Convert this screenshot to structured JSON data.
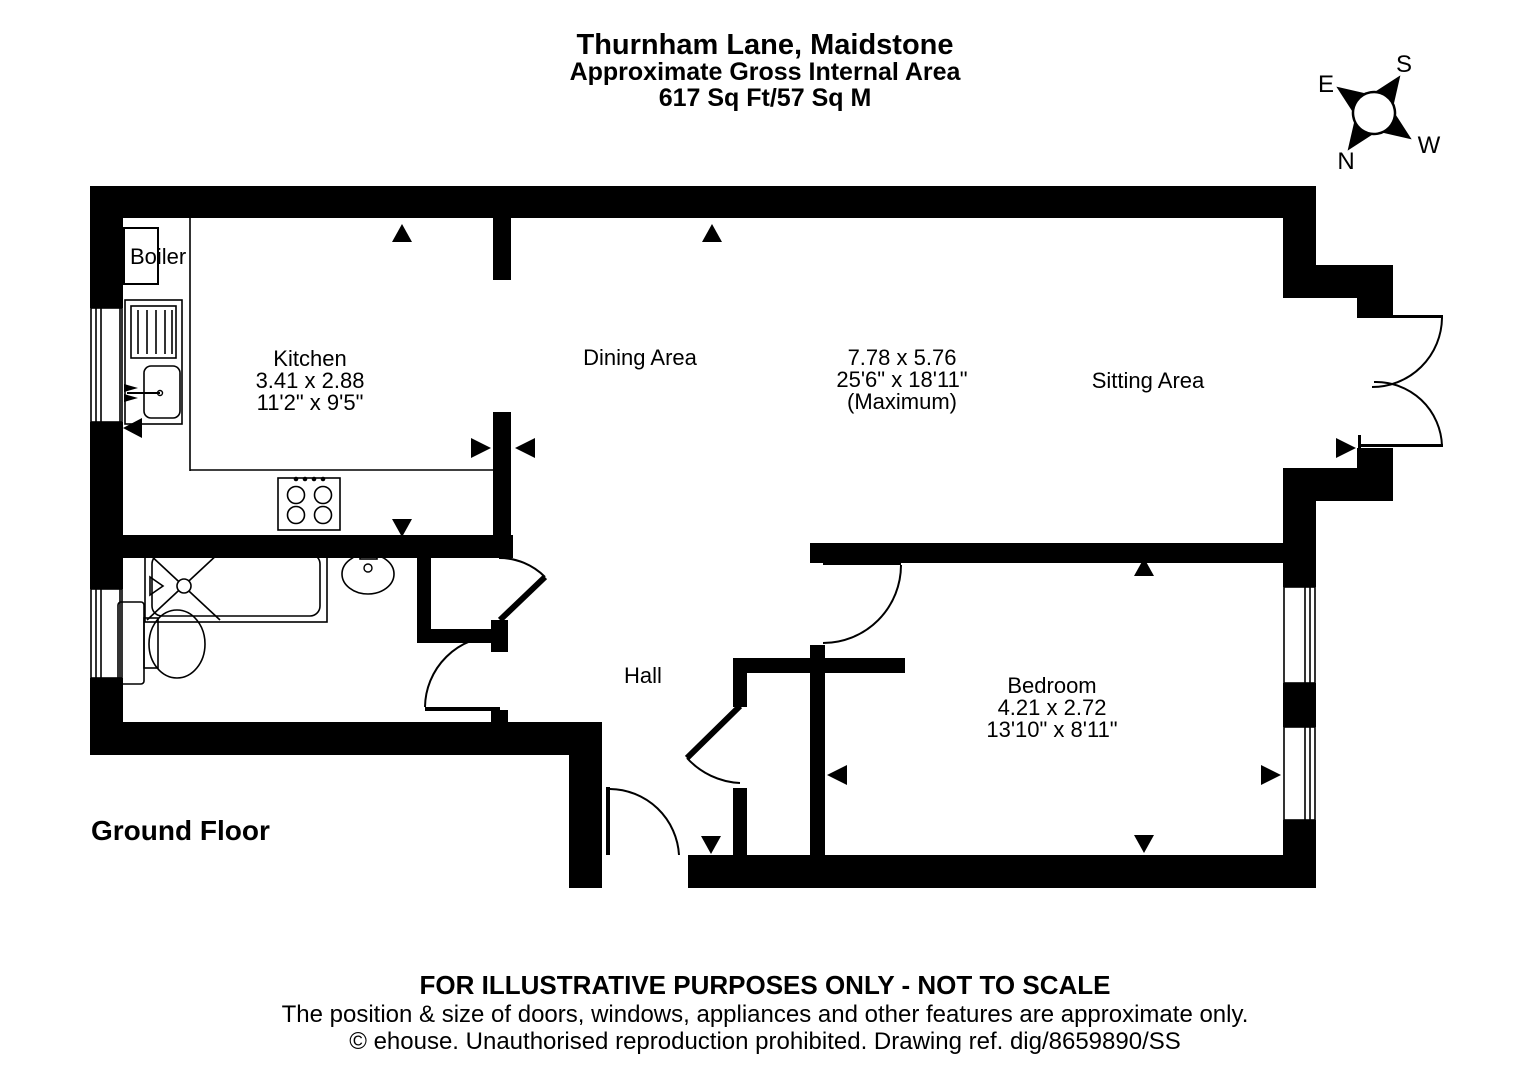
{
  "title": {
    "line1": "Thurnham Lane, Maidstone",
    "line2": "Approximate Gross Internal Area",
    "line3": "617 Sq Ft/57 Sq M"
  },
  "compass": {
    "n": "N",
    "s": "S",
    "e": "E",
    "w": "W"
  },
  "floor_label": "Ground Floor",
  "rooms": {
    "kitchen": {
      "name": "Kitchen",
      "metric": "3.41 x 2.88",
      "imperial": "11'2\" x 9'5\""
    },
    "dining": {
      "name": "Dining Area"
    },
    "sitting": {
      "name": "Sitting Area",
      "metric": "7.78 x 5.76",
      "imperial": "25'6\" x 18'11\"",
      "note": "(Maximum)"
    },
    "hall": {
      "name": "Hall"
    },
    "bedroom": {
      "name": "Bedroom",
      "metric": "4.21 x 2.72",
      "imperial": "13'10\" x 8'11\""
    },
    "boiler": {
      "name": "Boiler"
    }
  },
  "footer": {
    "line1": "FOR ILLUSTRATIVE PURPOSES ONLY - NOT TO SCALE",
    "line2": "The position & size of doors, windows, appliances and other features are approximate only.",
    "line3": "© ehouse. Unauthorised reproduction prohibited. Drawing ref. dig/8659890/SS"
  },
  "colors": {
    "wall": "#000000",
    "background": "#ffffff"
  }
}
